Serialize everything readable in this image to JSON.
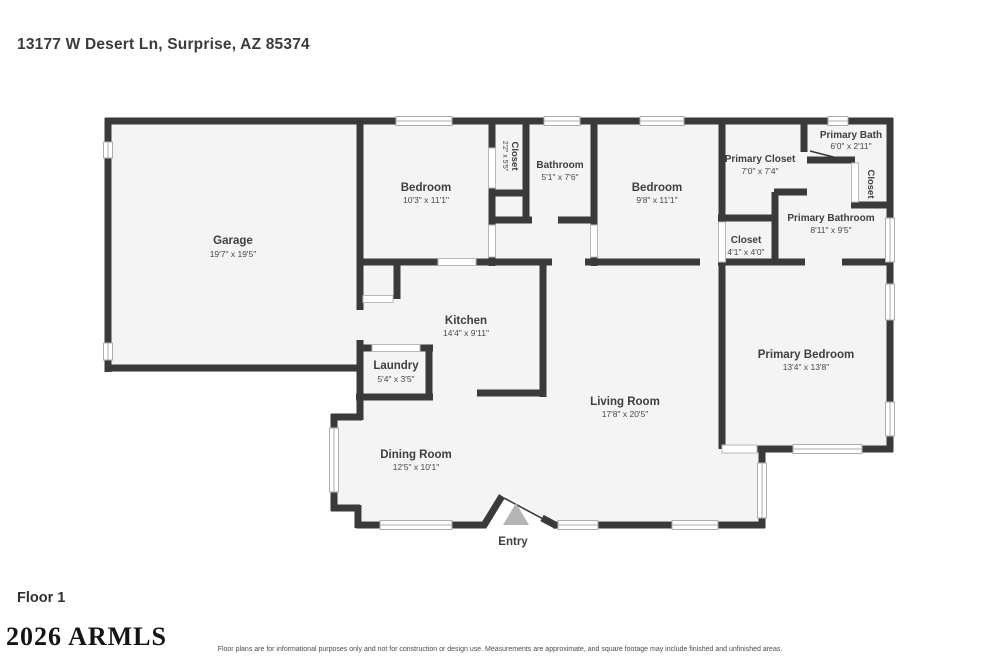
{
  "page": {
    "title": "13177 W Desert Ln, Surprise, AZ 85374",
    "floor_label": "Floor 1",
    "watermark": "2026 ARMLS",
    "disclaimer": "Floor plans are for informational purposes only and not for construction or design use. Measurements are approximate, and square footage may include finished and unfinished areas."
  },
  "colors": {
    "wall": "#3a3a3a",
    "floor_fill": "#f4f4f4",
    "background": "#ffffff",
    "label_text": "#3e3e43",
    "entry_marker": "#b5b5b5"
  },
  "rooms": [
    {
      "name": "Garage",
      "dims": "19'7\" x 19'5\""
    },
    {
      "name": "Bedroom",
      "dims": "10'3\" x 11'1\""
    },
    {
      "name": "Closet",
      "dims": "2'2\" x 5'5\""
    },
    {
      "name": "Bathroom",
      "dims": "5'1\" x 7'6\""
    },
    {
      "name": "Bedroom",
      "dims": "9'8\" x 11'1\""
    },
    {
      "name": "Primary Closet",
      "dims": "7'0\" x 7'4\""
    },
    {
      "name": "Primary Bath",
      "dims": "6'0\" x 2'11\""
    },
    {
      "name": "Closet",
      "dims": ""
    },
    {
      "name": "Primary Bathroom",
      "dims": "8'11\" x 9'5\""
    },
    {
      "name": "Closet",
      "dims": "4'1\" x 4'0\""
    },
    {
      "name": "Kitchen",
      "dims": "14'4\" x 9'11\""
    },
    {
      "name": "Laundry",
      "dims": "5'4\" x 3'5\""
    },
    {
      "name": "Living Room",
      "dims": "17'8\" x 20'5\""
    },
    {
      "name": "Dining Room",
      "dims": "12'5\" x 10'1\""
    },
    {
      "name": "Primary Bedroom",
      "dims": "13'4\" x 13'8\""
    },
    {
      "name": "Entry",
      "dims": ""
    }
  ]
}
